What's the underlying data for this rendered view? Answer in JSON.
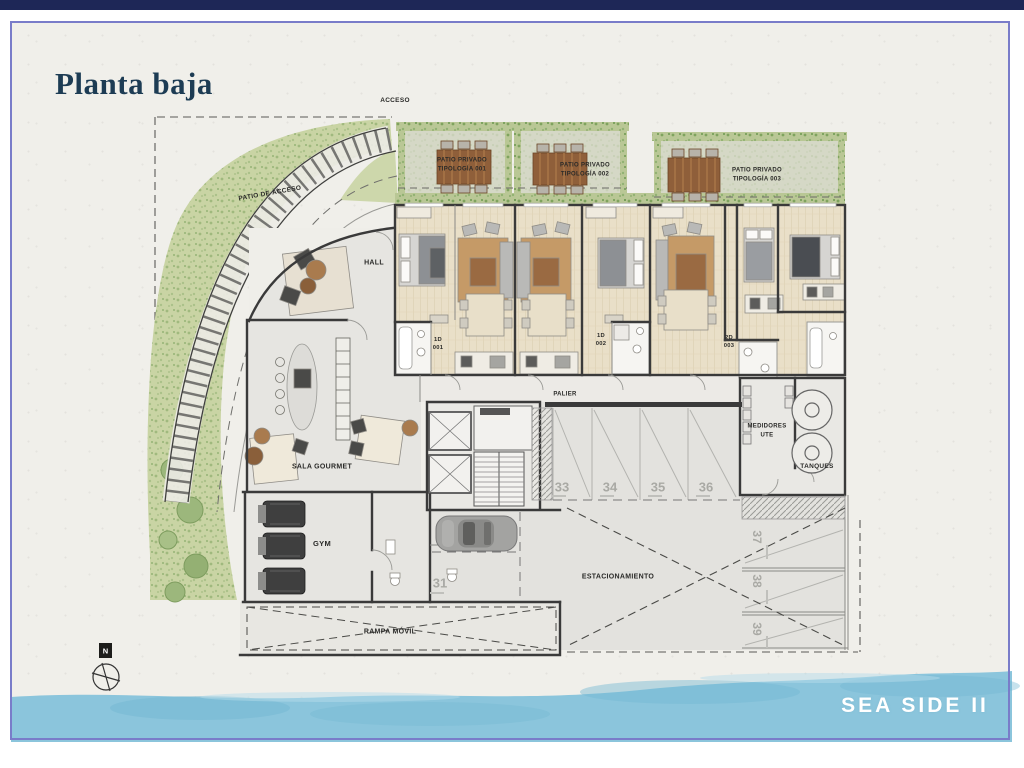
{
  "header": {
    "title": "Planta baja"
  },
  "plan": {
    "acceso": "ACCESO",
    "patio_de_acceso": "PATIO DE ACCESO",
    "patios": [
      {
        "l1": "PATIO PRIVADO",
        "l2": "TIPOLOGÍA 001"
      },
      {
        "l1": "PATIO PRIVADO",
        "l2": "TIPOLOGÍA 002"
      },
      {
        "l1": "PATIO PRIVADO",
        "l2": "TIPOLOGÍA 003"
      }
    ],
    "units": [
      {
        "type": "1D",
        "num": "001"
      },
      {
        "type": "1D",
        "num": "002"
      },
      {
        "type": "2D",
        "num": "003"
      }
    ],
    "rooms": {
      "hall": "HALL",
      "sala_gourmet": "SALA GOURMET",
      "gym": "GYM",
      "palier": "PALIER",
      "medidores_l1": "MEDIDORES",
      "medidores_l2": "UTE",
      "tanques": "TANQUES",
      "estacionamiento": "ESTACIONAMIENTO",
      "rampa_movil": "RAMPA MÓVIL"
    },
    "parking_spots": [
      "31",
      "33",
      "34",
      "35",
      "36"
    ],
    "parking_spots_vertical": [
      "37",
      "38",
      "39"
    ],
    "compass_n": "N"
  },
  "footer": {
    "project_name": "SEA SIDE II"
  },
  "colors": {
    "top_bar": "#1e2757",
    "frame_border": "#797cc9",
    "title_text": "#1d3c54",
    "water": "#8bc5dc",
    "greenery": "#c9d4a4",
    "wood_floor": "#e9dfc8",
    "wall": "#3a3a3a"
  }
}
